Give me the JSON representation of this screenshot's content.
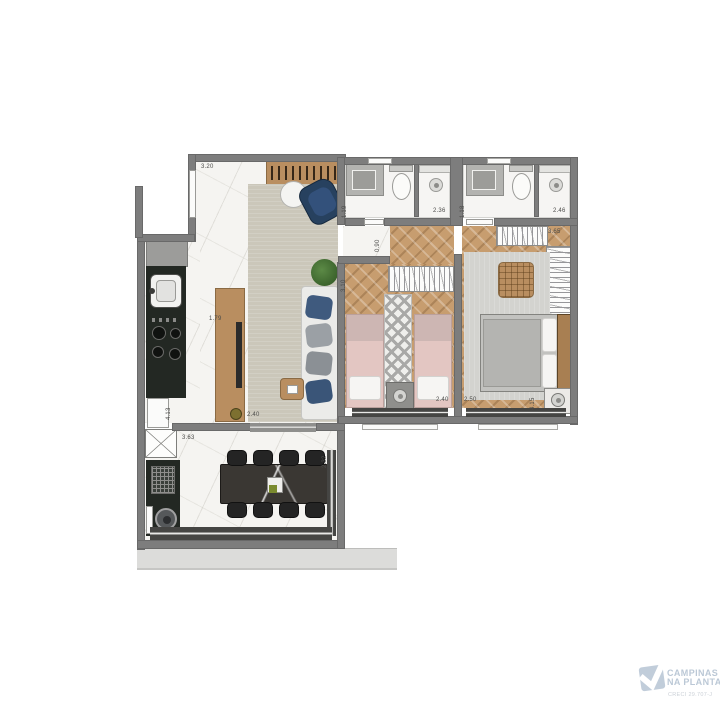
{
  "plan": {
    "kind": "apartment-floor-plan",
    "rooms_visible_text": "none (only dimension labels shown)"
  },
  "palette": {
    "wall": "#7d7d7d",
    "floor_marble": "#f5f4f1",
    "floor_wood_herringbone": "#c79d6f",
    "counter_dark": "#232823",
    "wood_furniture": "#b98e60",
    "rug_living": "#cbc7ba",
    "rug_bedroom": "#d3d3cf",
    "bed_pink": "#e3c6c2",
    "bed_gray": "#c2c2bf",
    "navy_accent": "#2b4565",
    "dining_table": "#3a3733",
    "balcony_slab": "#dcdcda",
    "logo_blue": "#b6c4d3"
  },
  "dims": [
    {
      "id": "living-top",
      "text": "3.20"
    },
    {
      "id": "tv-panel",
      "text": "1.79"
    },
    {
      "id": "living-rug",
      "text": "2.40"
    },
    {
      "id": "kitchen-depth",
      "text": "4.13"
    },
    {
      "id": "dining-width",
      "text": "3.63"
    },
    {
      "id": "dining-depth",
      "text": "2.32"
    },
    {
      "id": "bath1-depth",
      "text": "1.19"
    },
    {
      "id": "bath1-width",
      "text": "2.36"
    },
    {
      "id": "bath2-depth",
      "text": "1.18"
    },
    {
      "id": "bath2-width",
      "text": "2.46"
    },
    {
      "id": "hall-width",
      "text": "0.90"
    },
    {
      "id": "bedroom1-depth",
      "text": "3.10"
    },
    {
      "id": "bedroom1-width",
      "text": "2.40"
    },
    {
      "id": "wardrobe2-width",
      "text": "3.65"
    },
    {
      "id": "bedroom2-width",
      "text": "2.50"
    },
    {
      "id": "bedroom2-depth",
      "text": "4.15"
    }
  ],
  "logo": {
    "line1": "CAMPINAS",
    "line2": "NA PLANTA",
    "creci": "CRECI 29.707-J"
  }
}
